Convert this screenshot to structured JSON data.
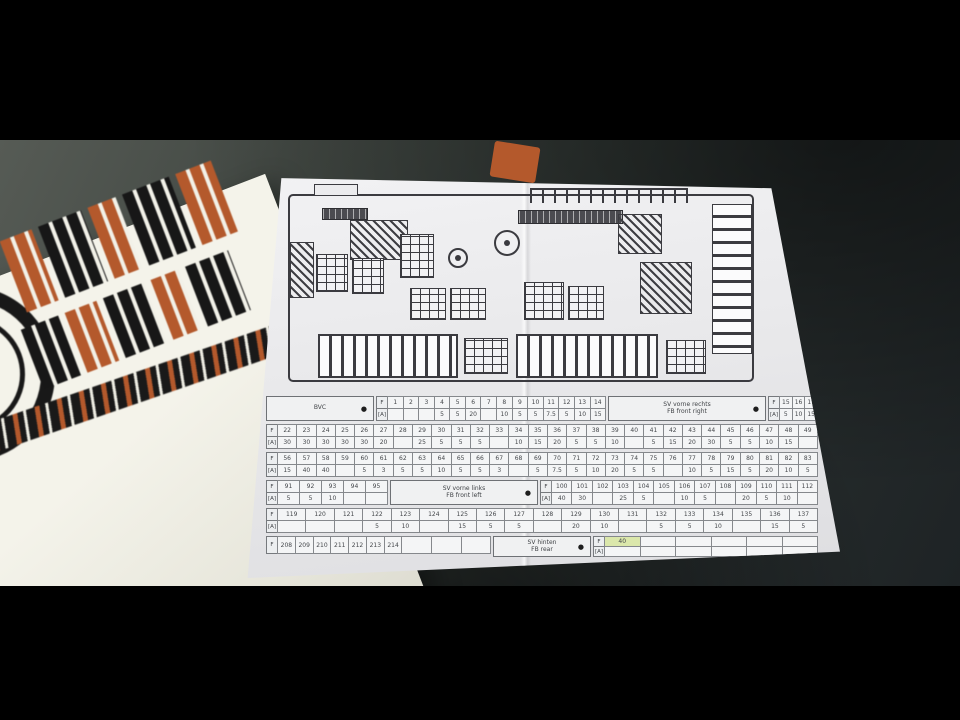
{
  "scene": {
    "colors": {
      "letterbox": "#000000",
      "desk": "#323834",
      "paper": "#ececee",
      "sticker_sheet": "#f2f1e8",
      "logo_orange": "#b4592c",
      "logo_black": "#181818",
      "diagram_ink": "#3b3b40",
      "highlight_cell": "#dbe7ab"
    }
  },
  "paper": {
    "legend": {
      "bullet": "●",
      "row_label_fuse": "F",
      "row_label_amp": "[A]",
      "groups": [
        {
          "box": {
            "name": "box-bvc",
            "line1": "BVC"
          },
          "f": [
            "1",
            "2",
            "3",
            "4",
            "5",
            "6",
            "7",
            "8",
            "9",
            "10",
            "11",
            "12",
            "13",
            "14"
          ],
          "a": [
            "",
            "",
            "",
            "5",
            "5",
            "20",
            "",
            "10",
            "5",
            "5",
            "7.5",
            "5",
            "10",
            "15"
          ],
          "box2": {
            "name": "box-sv-front-right",
            "line1": "SV vorne rechts",
            "line2": "FB front right"
          },
          "f2": [
            "15",
            "16",
            "17"
          ],
          "a2": [
            "5",
            "10",
            "15"
          ]
        },
        {
          "f": [
            "22",
            "23",
            "24",
            "25",
            "26",
            "27",
            "28",
            "29",
            "30",
            "31",
            "32",
            "33",
            "34",
            "35",
            "36",
            "37",
            "38",
            "39",
            "40",
            "41",
            "42",
            "43",
            "44",
            "45",
            "46",
            "47",
            "48",
            "49"
          ],
          "a": [
            "30",
            "30",
            "30",
            "30",
            "30",
            "20",
            "",
            "25",
            "5",
            "5",
            "5",
            "",
            "10",
            "15",
            "20",
            "5",
            "5",
            "10",
            "",
            "5",
            "15",
            "20",
            "30",
            "5",
            "5",
            "10",
            "15",
            ""
          ]
        },
        {
          "f": [
            "56",
            "57",
            "58",
            "59",
            "60",
            "61",
            "62",
            "63",
            "64",
            "65",
            "66",
            "67",
            "68",
            "69",
            "70",
            "71",
            "72",
            "73",
            "74",
            "75",
            "76",
            "77",
            "78",
            "79",
            "80",
            "81",
            "82",
            "83"
          ],
          "a": [
            "15",
            "40",
            "40",
            "",
            "5",
            "3",
            "5",
            "5",
            "10",
            "5",
            "5",
            "3",
            "",
            "5",
            "7.5",
            "5",
            "10",
            "20",
            "5",
            "5",
            "",
            "10",
            "5",
            "15",
            "5",
            "20",
            "10",
            "5"
          ]
        },
        {
          "f": [
            "91",
            "92",
            "93",
            "94",
            "95"
          ],
          "a": [
            "5",
            "5",
            "10",
            "",
            ""
          ],
          "box2": {
            "name": "box-sv-front-left",
            "line1": "SV vorne links",
            "line2": "FB front left"
          },
          "f2": [
            "100",
            "101",
            "102",
            "103",
            "104",
            "105",
            "106",
            "107",
            "108",
            "109",
            "110",
            "111",
            "112"
          ],
          "a2": [
            "40",
            "30",
            "",
            "25",
            "5",
            "",
            "10",
            "5",
            "",
            "20",
            "5",
            "10",
            ""
          ]
        },
        {
          "f": [
            "119",
            "120",
            "121",
            "122",
            "123",
            "124",
            "125",
            "126",
            "127",
            "128",
            "129",
            "130",
            "131",
            "132",
            "133",
            "134",
            "135",
            "136",
            "137"
          ],
          "a": [
            "",
            "",
            "",
            "5",
            "10",
            "",
            "15",
            "5",
            "5",
            "",
            "20",
            "10",
            "",
            "5",
            "5",
            "10",
            "",
            "15",
            "5"
          ]
        },
        {
          "f": [
            "208",
            "209",
            "210",
            "211",
            "212",
            "213",
            "214",
            "",
            "",
            ""
          ],
          "box2": {
            "name": "box-sv-rear",
            "line1": "SV hinten",
            "line2": "FB rear"
          },
          "f2": [
            "40",
            "",
            "",
            "",
            "",
            ""
          ],
          "a2": [
            "",
            "",
            "",
            "",
            "",
            ""
          ],
          "highlight2": 0
        }
      ]
    }
  }
}
